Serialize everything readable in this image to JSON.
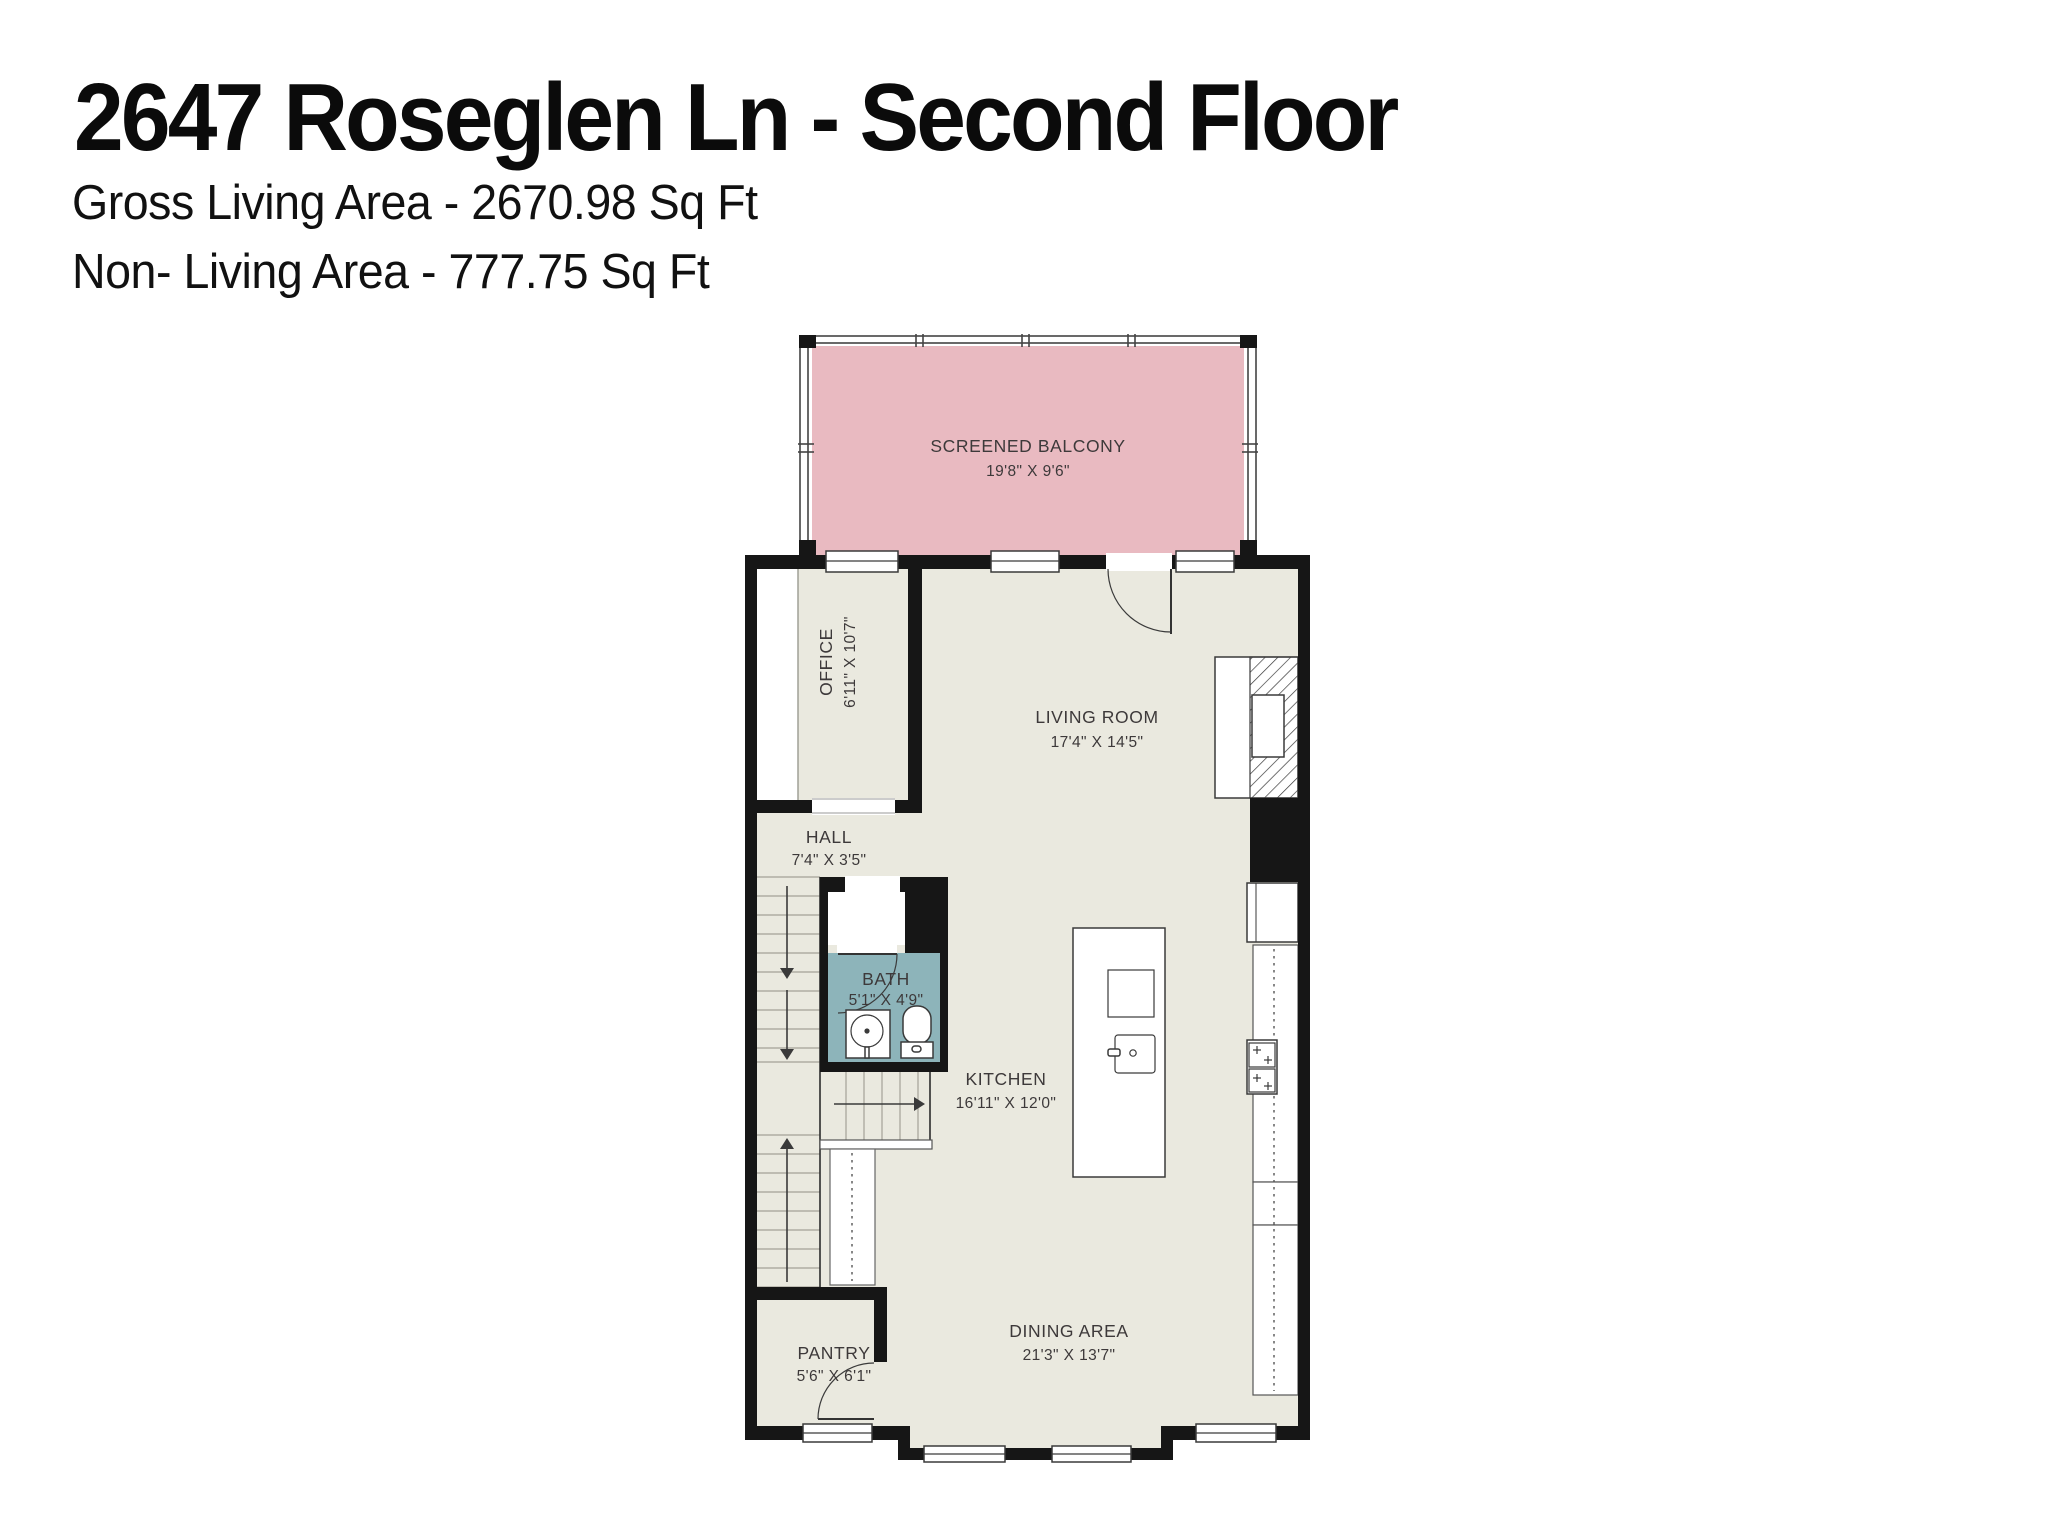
{
  "header": {
    "title": "2647 Roseglen Ln - Second Floor",
    "gross_living_area": "Gross Living Area - 2670.98 Sq Ft",
    "non_living_area": "Non- Living Area - 777.75 Sq Ft"
  },
  "rooms": {
    "balcony": {
      "name": "SCREENED BALCONY",
      "dims": "19'8\" X 9'6\""
    },
    "office": {
      "name": "OFFICE",
      "dims": "6'11\" X 10'7\""
    },
    "living": {
      "name": "LIVING ROOM",
      "dims": "17'4\" X 14'5\""
    },
    "hall": {
      "name": "HALL",
      "dims": "7'4\" X 3'5\""
    },
    "bath": {
      "name": "BATH",
      "dims": "5'1\" X 4'9\""
    },
    "kitchen": {
      "name": "KITCHEN",
      "dims": "16'11\" X 12'0\""
    },
    "dining": {
      "name": "DINING AREA",
      "dims": "21'3\" X 13'7\""
    },
    "pantry": {
      "name": "PANTRY",
      "dims": "5'6\" X 6'1\""
    }
  },
  "colors": {
    "balcony_fill": "#e9bac1",
    "bath_fill": "#8db4ba",
    "floor_fill": "#eae9df",
    "wall": "#161616",
    "label": "#3d393a"
  }
}
